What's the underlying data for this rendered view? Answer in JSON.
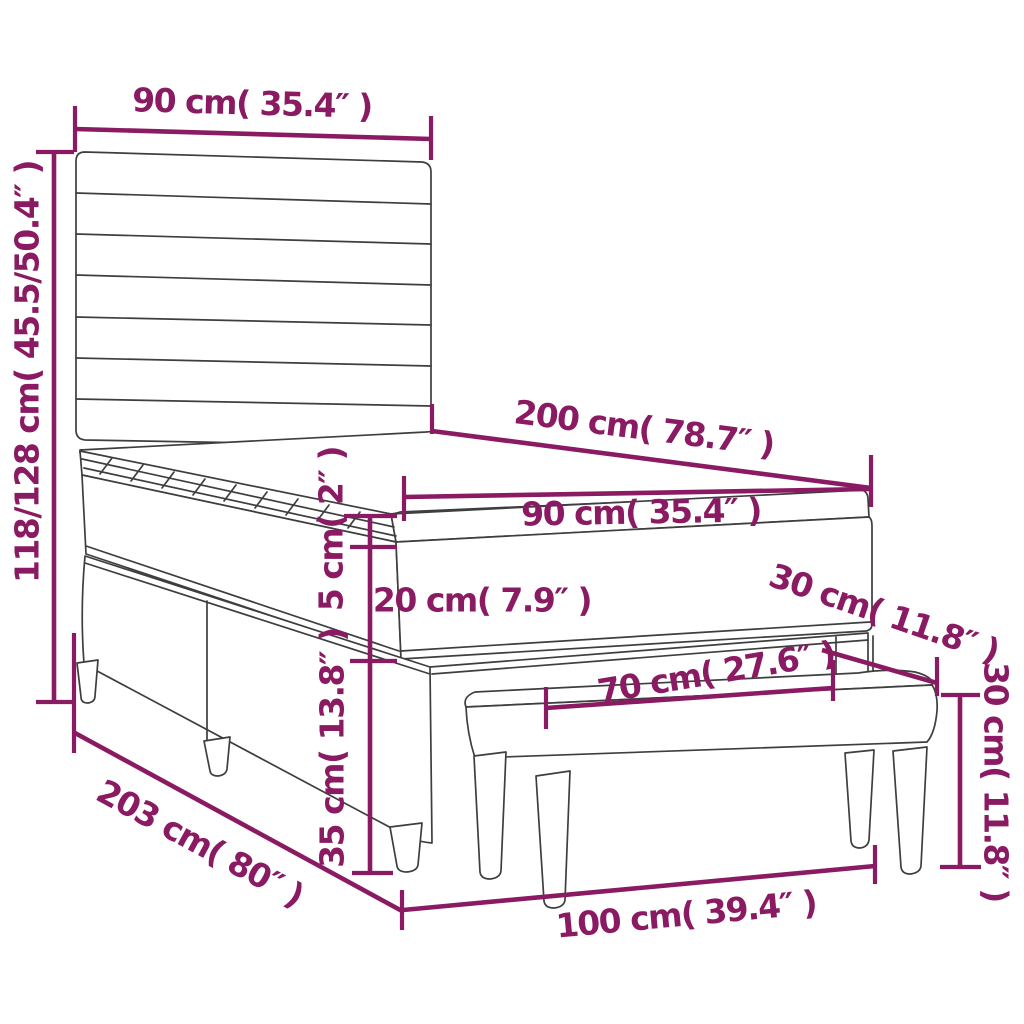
{
  "diagram": {
    "type": "product-dimension-diagram",
    "subject": "box spring bed with headboard, mattress topper and bench"
  },
  "colors": {
    "dimension_color": "#8a1b63",
    "outline_color": "#3e3e3e",
    "background": "#ffffff"
  },
  "dimensions": {
    "headboard_width": {
      "label": "90 cm( 35.4″ )"
    },
    "bed_height": {
      "label": "118/128 cm( 45.5/50.4″ )"
    },
    "mattress_length": {
      "label": "200 cm( 78.7″ )"
    },
    "mattress_width": {
      "label": "90 cm( 35.4″ )"
    },
    "topper_height": {
      "label": "5 cm( 2″ )"
    },
    "mattress_height": {
      "label": "20 cm( 7.9″ )"
    },
    "bench_depth": {
      "label": "30 cm( 11.8″ )"
    },
    "bench_length": {
      "label": "70 cm( 27.6″ )"
    },
    "bench_height": {
      "label": "30 cm( 11.8″ )"
    },
    "base_height": {
      "label": "35 cm( 13.8″ )"
    },
    "bed_total_length": {
      "label": "203 cm( 80″ )"
    },
    "bench_total_length": {
      "label": "100 cm( 39.4″ )"
    }
  }
}
